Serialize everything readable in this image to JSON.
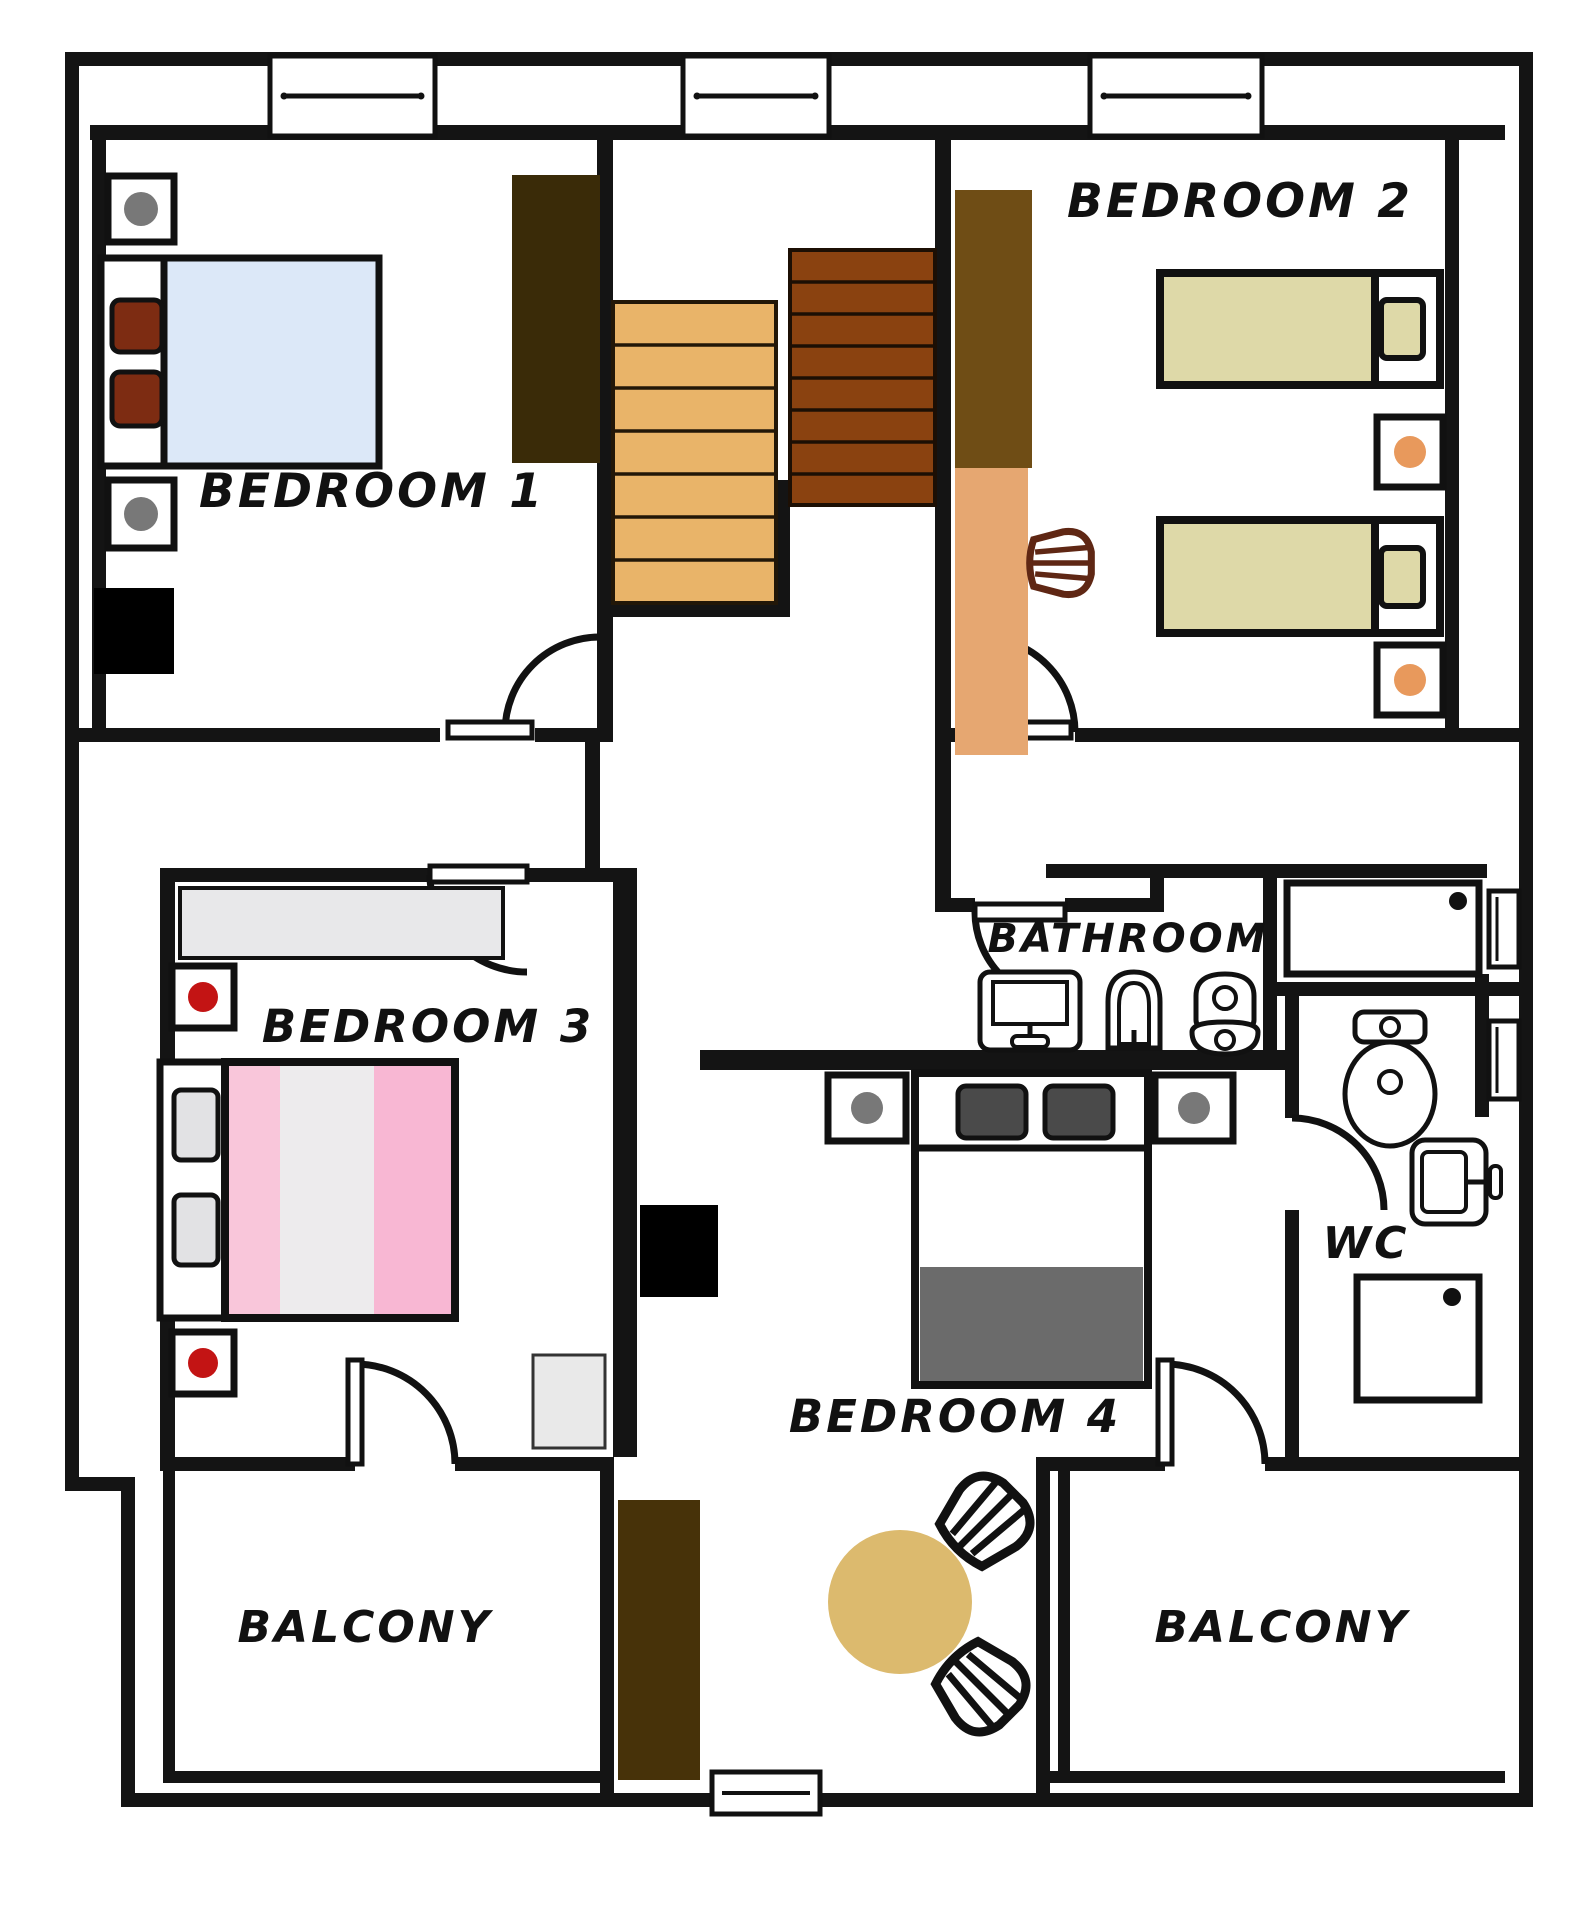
{
  "plan": {
    "type": "floor-plan",
    "floor": "upper floor with 4 bedrooms, bathroom, WC and 2 balconies"
  },
  "rooms": {
    "bedroom1": {
      "label": "BEDROOM 1"
    },
    "bedroom2": {
      "label": "BEDROOM 2"
    },
    "bedroom3": {
      "label": "BEDROOM 3"
    },
    "bedroom4": {
      "label": "BEDROOM 4"
    },
    "bathroom": {
      "label": "BATHROOM"
    },
    "wc": {
      "label": "WC"
    },
    "balcony_left": {
      "label": "BALCONY"
    },
    "balcony_right": {
      "label": "BALCONY"
    }
  },
  "colors": {
    "wall": "#141414",
    "bed1_mattress": "#dce8f8",
    "pillow_brown": "#7d2c12",
    "wardrobe_dark": "#3a2b08",
    "stairs_light": "#e9b469",
    "stairs_dark": "#8a4210",
    "wardrobe2_top": "#6f4d15",
    "desk_peach": "#e6a771",
    "bed2_mattress": "#ded9a8",
    "dot_orange": "#e8995c",
    "dot_gray": "#787878",
    "dot_red": "#c31414",
    "wardrobe3_gray": "#e8e8ea",
    "bed3_pink_light": "#f9c6da",
    "bed3_center": "#edebed",
    "bed3_pink": "#f8b7d3",
    "pillow_gray": "#e2e2e4",
    "rug_gray": "#e9e9e9",
    "rug_dark": "#473209",
    "bed4_blanket": "#6b6b6b",
    "pillow_dark": "#4a4a4a",
    "table_tan": "#dcba6e",
    "chair_brown": "#5f2714",
    "black": "#000000"
  }
}
